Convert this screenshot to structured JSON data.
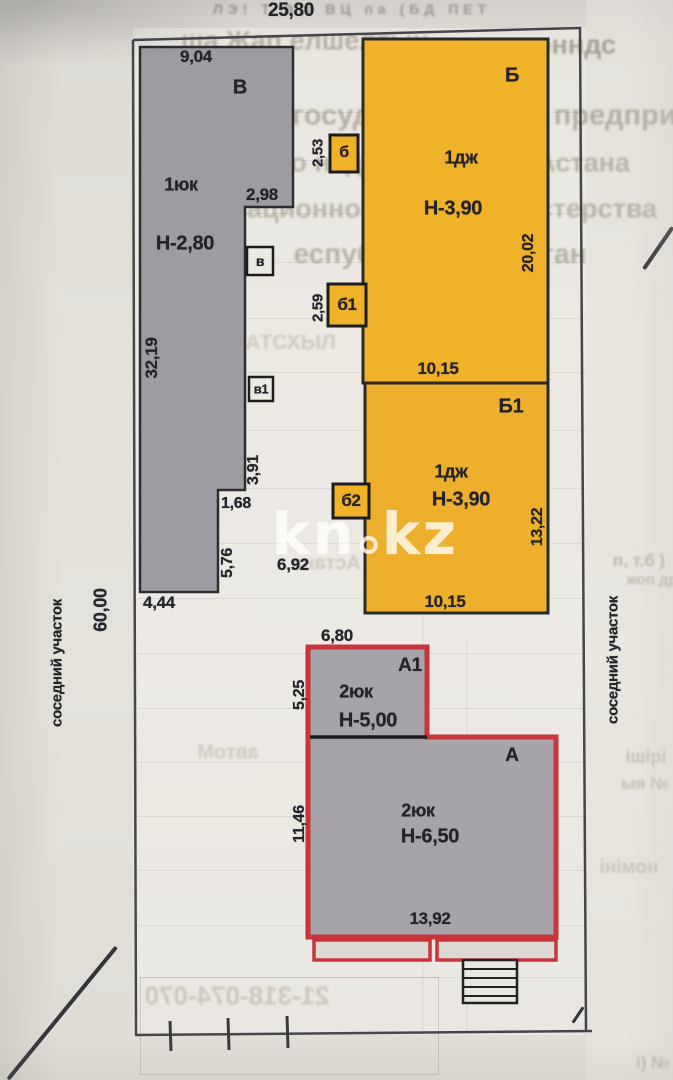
{
  "plan": {
    "dims": {
      "d2580": "25,80",
      "d6000": "60,00",
      "d904": "9,04",
      "d298": "2,98",
      "d3219": "32,19",
      "d391": "3,91",
      "d168": "1,68",
      "d576": "5,76",
      "d692": "6,92",
      "d444": "4,44",
      "d253": "2,53",
      "d259": "2,59",
      "d2002": "20,02",
      "d1015top": "10,15",
      "d1322": "13,22",
      "d1015bot": "10,15",
      "d680": "6,80",
      "d525": "5,25",
      "d1146": "11,46",
      "d1392": "13,92"
    },
    "buildings": {
      "V": {
        "label": "В",
        "floors": "1юк",
        "height": "Н-2,80"
      },
      "B": {
        "label": "Б",
        "floors": "1дж",
        "height": "Н-3,90"
      },
      "B1": {
        "label": "Б1",
        "floors": "1дж",
        "height": "Н-3,90"
      },
      "A1": {
        "label": "А1",
        "floors": "2юк",
        "height": "Н-5,00"
      },
      "A": {
        "label": "А",
        "floors": "2юк",
        "height": "Н-6,50"
      },
      "b": {
        "label": "б"
      },
      "b1": {
        "label": "б1"
      },
      "b2": {
        "label": "б2"
      },
      "v": {
        "label": "в"
      },
      "v1": {
        "label": "в1"
      }
    },
    "margins": {
      "left": "соседний участок",
      "right": "соседний участок"
    },
    "watermark": {
      "p1": "kn",
      "p2": "kz"
    },
    "colors": {
      "yellow": "#f0b228",
      "gray": "#9e9ca3",
      "red": "#c8353a"
    },
    "bleed": {
      "t1": "ЛЭ! Т Э / ВЦ  па   (БД ПЕТ",
      "t2": "ша Жап елшелтын",
      "t3": "эонндс",
      "t4": "нское государс  твенное предприят",
      "t5": "по недвижимо  ти  г. Астана",
      "t6": "ационное    уюбы министерства",
      "t7": "еспублики Казахстан",
      "t8": "НАТСХЫЛ",
      "t9": "Астана",
      "t10": "автоМ",
      "t11": "21-318-074-070",
      "t12": "п, т.б )",
      "t13": "жоп др",
      "t14": "ішірі",
      "t15": "ыя №",
      "t16": "номіні",
      "t17": "і) №"
    }
  }
}
